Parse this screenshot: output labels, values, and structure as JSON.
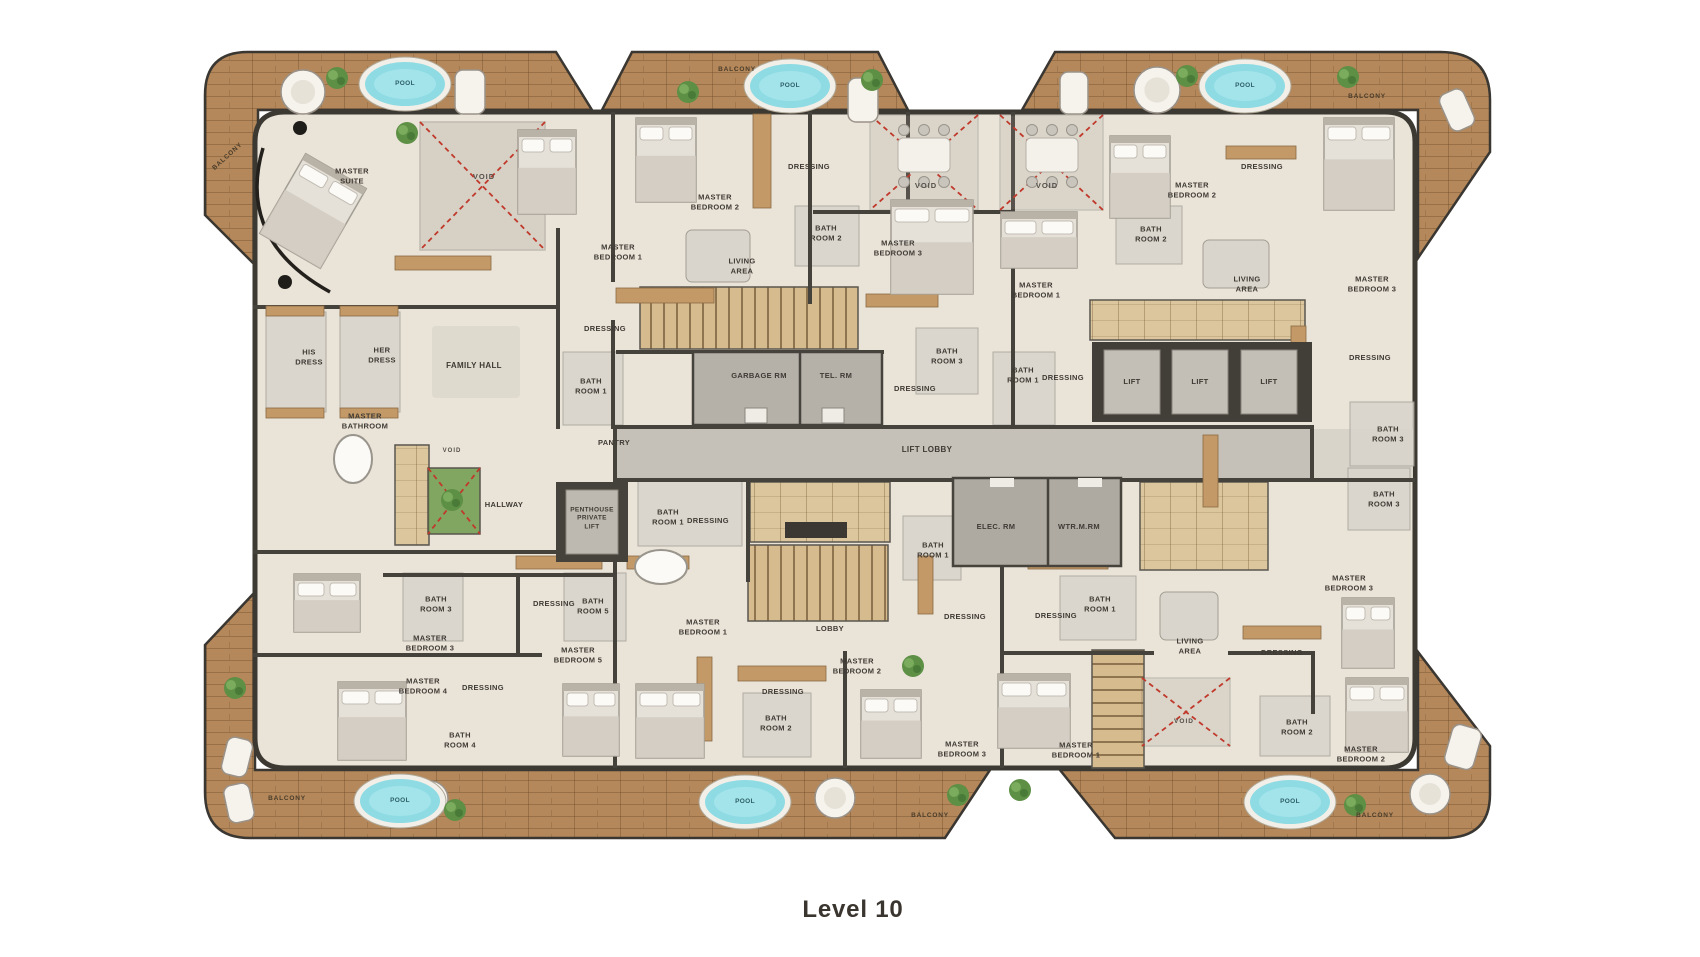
{
  "title": "Level 10",
  "colors": {
    "wood": "#b4885a",
    "floor": "#e9e3d8",
    "pool_water": "#8edbe4",
    "void_cross": "#c0392b",
    "wall": "#3c3832",
    "caption_text": "#3a352f"
  },
  "labels": [
    {
      "k": "pool",
      "t": "POOL",
      "x": 405,
      "y": 84,
      "s": 6.5
    },
    {
      "k": "pool",
      "t": "POOL",
      "x": 790,
      "y": 86,
      "s": 6.5
    },
    {
      "k": "pool",
      "t": "POOL",
      "x": 1245,
      "y": 86,
      "s": 6.5
    },
    {
      "k": "pool",
      "t": "POOL",
      "x": 400,
      "y": 801,
      "s": 6.5
    },
    {
      "k": "pool",
      "t": "POOL",
      "x": 745,
      "y": 802,
      "s": 6.5
    },
    {
      "k": "pool",
      "t": "POOL",
      "x": 1290,
      "y": 802,
      "s": 6.5
    },
    {
      "k": "balcony",
      "t": "BALCONY",
      "x": 228,
      "y": 157,
      "r": -42,
      "s": 6.5
    },
    {
      "k": "balcony",
      "t": "BALCONY",
      "x": 737,
      "y": 70,
      "s": 6.5
    },
    {
      "k": "balcony",
      "t": "BALCONY",
      "x": 1367,
      "y": 97,
      "s": 6.5
    },
    {
      "k": "balcony",
      "t": "BALCONY",
      "x": 287,
      "y": 799,
      "s": 6.5
    },
    {
      "k": "balcony",
      "t": "BALCONY",
      "x": 930,
      "y": 816,
      "s": 6.5
    },
    {
      "k": "balcony",
      "t": "BALCONY",
      "x": 1375,
      "y": 816,
      "s": 6.5
    },
    {
      "k": "lift",
      "t": "LIFT",
      "x": 1132,
      "y": 382
    },
    {
      "k": "lift",
      "t": "LIFT",
      "x": 1200,
      "y": 382
    },
    {
      "k": "lift",
      "t": "LIFT",
      "x": 1269,
      "y": 382
    },
    {
      "k": "void",
      "t": "VOID",
      "x": 484,
      "y": 177
    },
    {
      "k": "void",
      "t": "VOID",
      "x": 926,
      "y": 186
    },
    {
      "k": "void",
      "t": "VOID",
      "x": 1047,
      "y": 186
    },
    {
      "k": "void",
      "t": "VOID",
      "x": 452,
      "y": 452,
      "s": 6
    },
    {
      "k": "void",
      "t": "VOID",
      "x": 1184,
      "y": 722,
      "s": 6.5
    },
    {
      "k": "room",
      "t": "MASTER\nSUITE",
      "x": 352,
      "y": 176
    },
    {
      "k": "room",
      "t": "MASTER\nBEDROOM 1",
      "x": 618,
      "y": 252
    },
    {
      "k": "room",
      "t": "DRESSING",
      "x": 605,
      "y": 329
    },
    {
      "k": "room",
      "t": "MASTER\nBEDROOM 2",
      "x": 715,
      "y": 202
    },
    {
      "k": "room",
      "t": "DRESSING",
      "x": 809,
      "y": 167
    },
    {
      "k": "room",
      "t": "BATH\nROOM 2",
      "x": 826,
      "y": 233
    },
    {
      "k": "room",
      "t": "LIVING\nAREA",
      "x": 742,
      "y": 266
    },
    {
      "k": "room",
      "t": "MASTER\nBEDROOM 3",
      "x": 898,
      "y": 248
    },
    {
      "k": "room",
      "t": "BATH\nROOM 3",
      "x": 947,
      "y": 356
    },
    {
      "k": "room",
      "t": "DRESSING",
      "x": 915,
      "y": 389
    },
    {
      "k": "room",
      "t": "MASTER\nBEDROOM 1",
      "x": 1036,
      "y": 290
    },
    {
      "k": "room",
      "t": "MASTER\nBEDROOM 2",
      "x": 1192,
      "y": 190
    },
    {
      "k": "room",
      "t": "DRESSING",
      "x": 1262,
      "y": 167
    },
    {
      "k": "room",
      "t": "BATH\nROOM 2",
      "x": 1151,
      "y": 234
    },
    {
      "k": "room",
      "t": "LIVING\nAREA",
      "x": 1247,
      "y": 284
    },
    {
      "k": "room",
      "t": "MASTER\nBEDROOM 3",
      "x": 1372,
      "y": 284
    },
    {
      "k": "room",
      "t": "BATH\nROOM 1",
      "x": 1023,
      "y": 375
    },
    {
      "k": "room",
      "t": "DRESSING",
      "x": 1063,
      "y": 378
    },
    {
      "k": "room",
      "t": "DRESSING",
      "x": 1370,
      "y": 358
    },
    {
      "k": "room",
      "t": "BATH\nROOM 3",
      "x": 1388,
      "y": 434
    },
    {
      "k": "room",
      "t": "BATH\nROOM 3",
      "x": 1384,
      "y": 499
    },
    {
      "k": "room",
      "t": "HIS\nDRESS",
      "x": 309,
      "y": 357
    },
    {
      "k": "room",
      "t": "HER\nDRESS",
      "x": 382,
      "y": 355
    },
    {
      "k": "room",
      "t": "FAMILY HALL",
      "x": 474,
      "y": 366,
      "s": 8
    },
    {
      "k": "room",
      "t": "MASTER\nBATHROOM",
      "x": 365,
      "y": 421
    },
    {
      "k": "room",
      "t": "BATH\nROOM 1",
      "x": 591,
      "y": 386
    },
    {
      "k": "room",
      "t": "PANTRY",
      "x": 614,
      "y": 443
    },
    {
      "k": "room",
      "t": "HALLWAY",
      "x": 504,
      "y": 505
    },
    {
      "k": "room",
      "t": "PENTHOUSE\nPRIVATE\nLIFT",
      "x": 592,
      "y": 519,
      "s": 6.5
    },
    {
      "k": "room",
      "t": "GARBAGE RM",
      "x": 759,
      "y": 376
    },
    {
      "k": "room",
      "t": "TEL. RM",
      "x": 836,
      "y": 376
    },
    {
      "k": "room",
      "t": "LIFT LOBBY",
      "x": 927,
      "y": 450,
      "s": 8
    },
    {
      "k": "room",
      "t": "ELEC. RM",
      "x": 996,
      "y": 527
    },
    {
      "k": "room",
      "t": "WTR.M.RM",
      "x": 1079,
      "y": 527
    },
    {
      "k": "room",
      "t": "BATH\nROOM 1",
      "x": 668,
      "y": 517
    },
    {
      "k": "room",
      "t": "DRESSING",
      "x": 708,
      "y": 521
    },
    {
      "k": "room",
      "t": "BATH\nROOM 1",
      "x": 933,
      "y": 550
    },
    {
      "k": "room",
      "t": "DRESSING",
      "x": 965,
      "y": 617
    },
    {
      "k": "room",
      "t": "BATH\nROOM 3",
      "x": 436,
      "y": 604
    },
    {
      "k": "room",
      "t": "MASTER\nBEDROOM 3",
      "x": 430,
      "y": 643
    },
    {
      "k": "room",
      "t": "DRESSING",
      "x": 554,
      "y": 604
    },
    {
      "k": "room",
      "t": "BATH\nROOM 5",
      "x": 593,
      "y": 606
    },
    {
      "k": "room",
      "t": "MASTER\nBEDROOM 5",
      "x": 578,
      "y": 655
    },
    {
      "k": "room",
      "t": "MASTER\nBEDROOM 4",
      "x": 423,
      "y": 686
    },
    {
      "k": "room",
      "t": "DRESSING",
      "x": 483,
      "y": 688
    },
    {
      "k": "room",
      "t": "BATH\nROOM 4",
      "x": 460,
      "y": 740
    },
    {
      "k": "room",
      "t": "MASTER\nBEDROOM 1",
      "x": 703,
      "y": 627
    },
    {
      "k": "room",
      "t": "LOBBY",
      "x": 830,
      "y": 629
    },
    {
      "k": "room",
      "t": "DRESSING",
      "x": 783,
      "y": 692
    },
    {
      "k": "room",
      "t": "MASTER\nBEDROOM 2",
      "x": 857,
      "y": 666
    },
    {
      "k": "room",
      "t": "BATH\nROOM 2",
      "x": 776,
      "y": 723
    },
    {
      "k": "room",
      "t": "MASTER\nBEDROOM 3",
      "x": 962,
      "y": 749
    },
    {
      "k": "room",
      "t": "DRESSING",
      "x": 1056,
      "y": 616
    },
    {
      "k": "room",
      "t": "BATH\nROOM 1",
      "x": 1100,
      "y": 604
    },
    {
      "k": "room",
      "t": "LIVING\nAREA",
      "x": 1190,
      "y": 646
    },
    {
      "k": "room",
      "t": "MASTER\nBEDROOM 1",
      "x": 1076,
      "y": 750
    },
    {
      "k": "room",
      "t": "BATH\nROOM 2",
      "x": 1297,
      "y": 727
    },
    {
      "k": "room",
      "t": "MASTER\nBEDROOM 2",
      "x": 1361,
      "y": 754
    },
    {
      "k": "room",
      "t": "MASTER\nBEDROOM 3",
      "x": 1349,
      "y": 583
    },
    {
      "k": "room",
      "t": "DRESSING",
      "x": 1282,
      "y": 653
    }
  ]
}
